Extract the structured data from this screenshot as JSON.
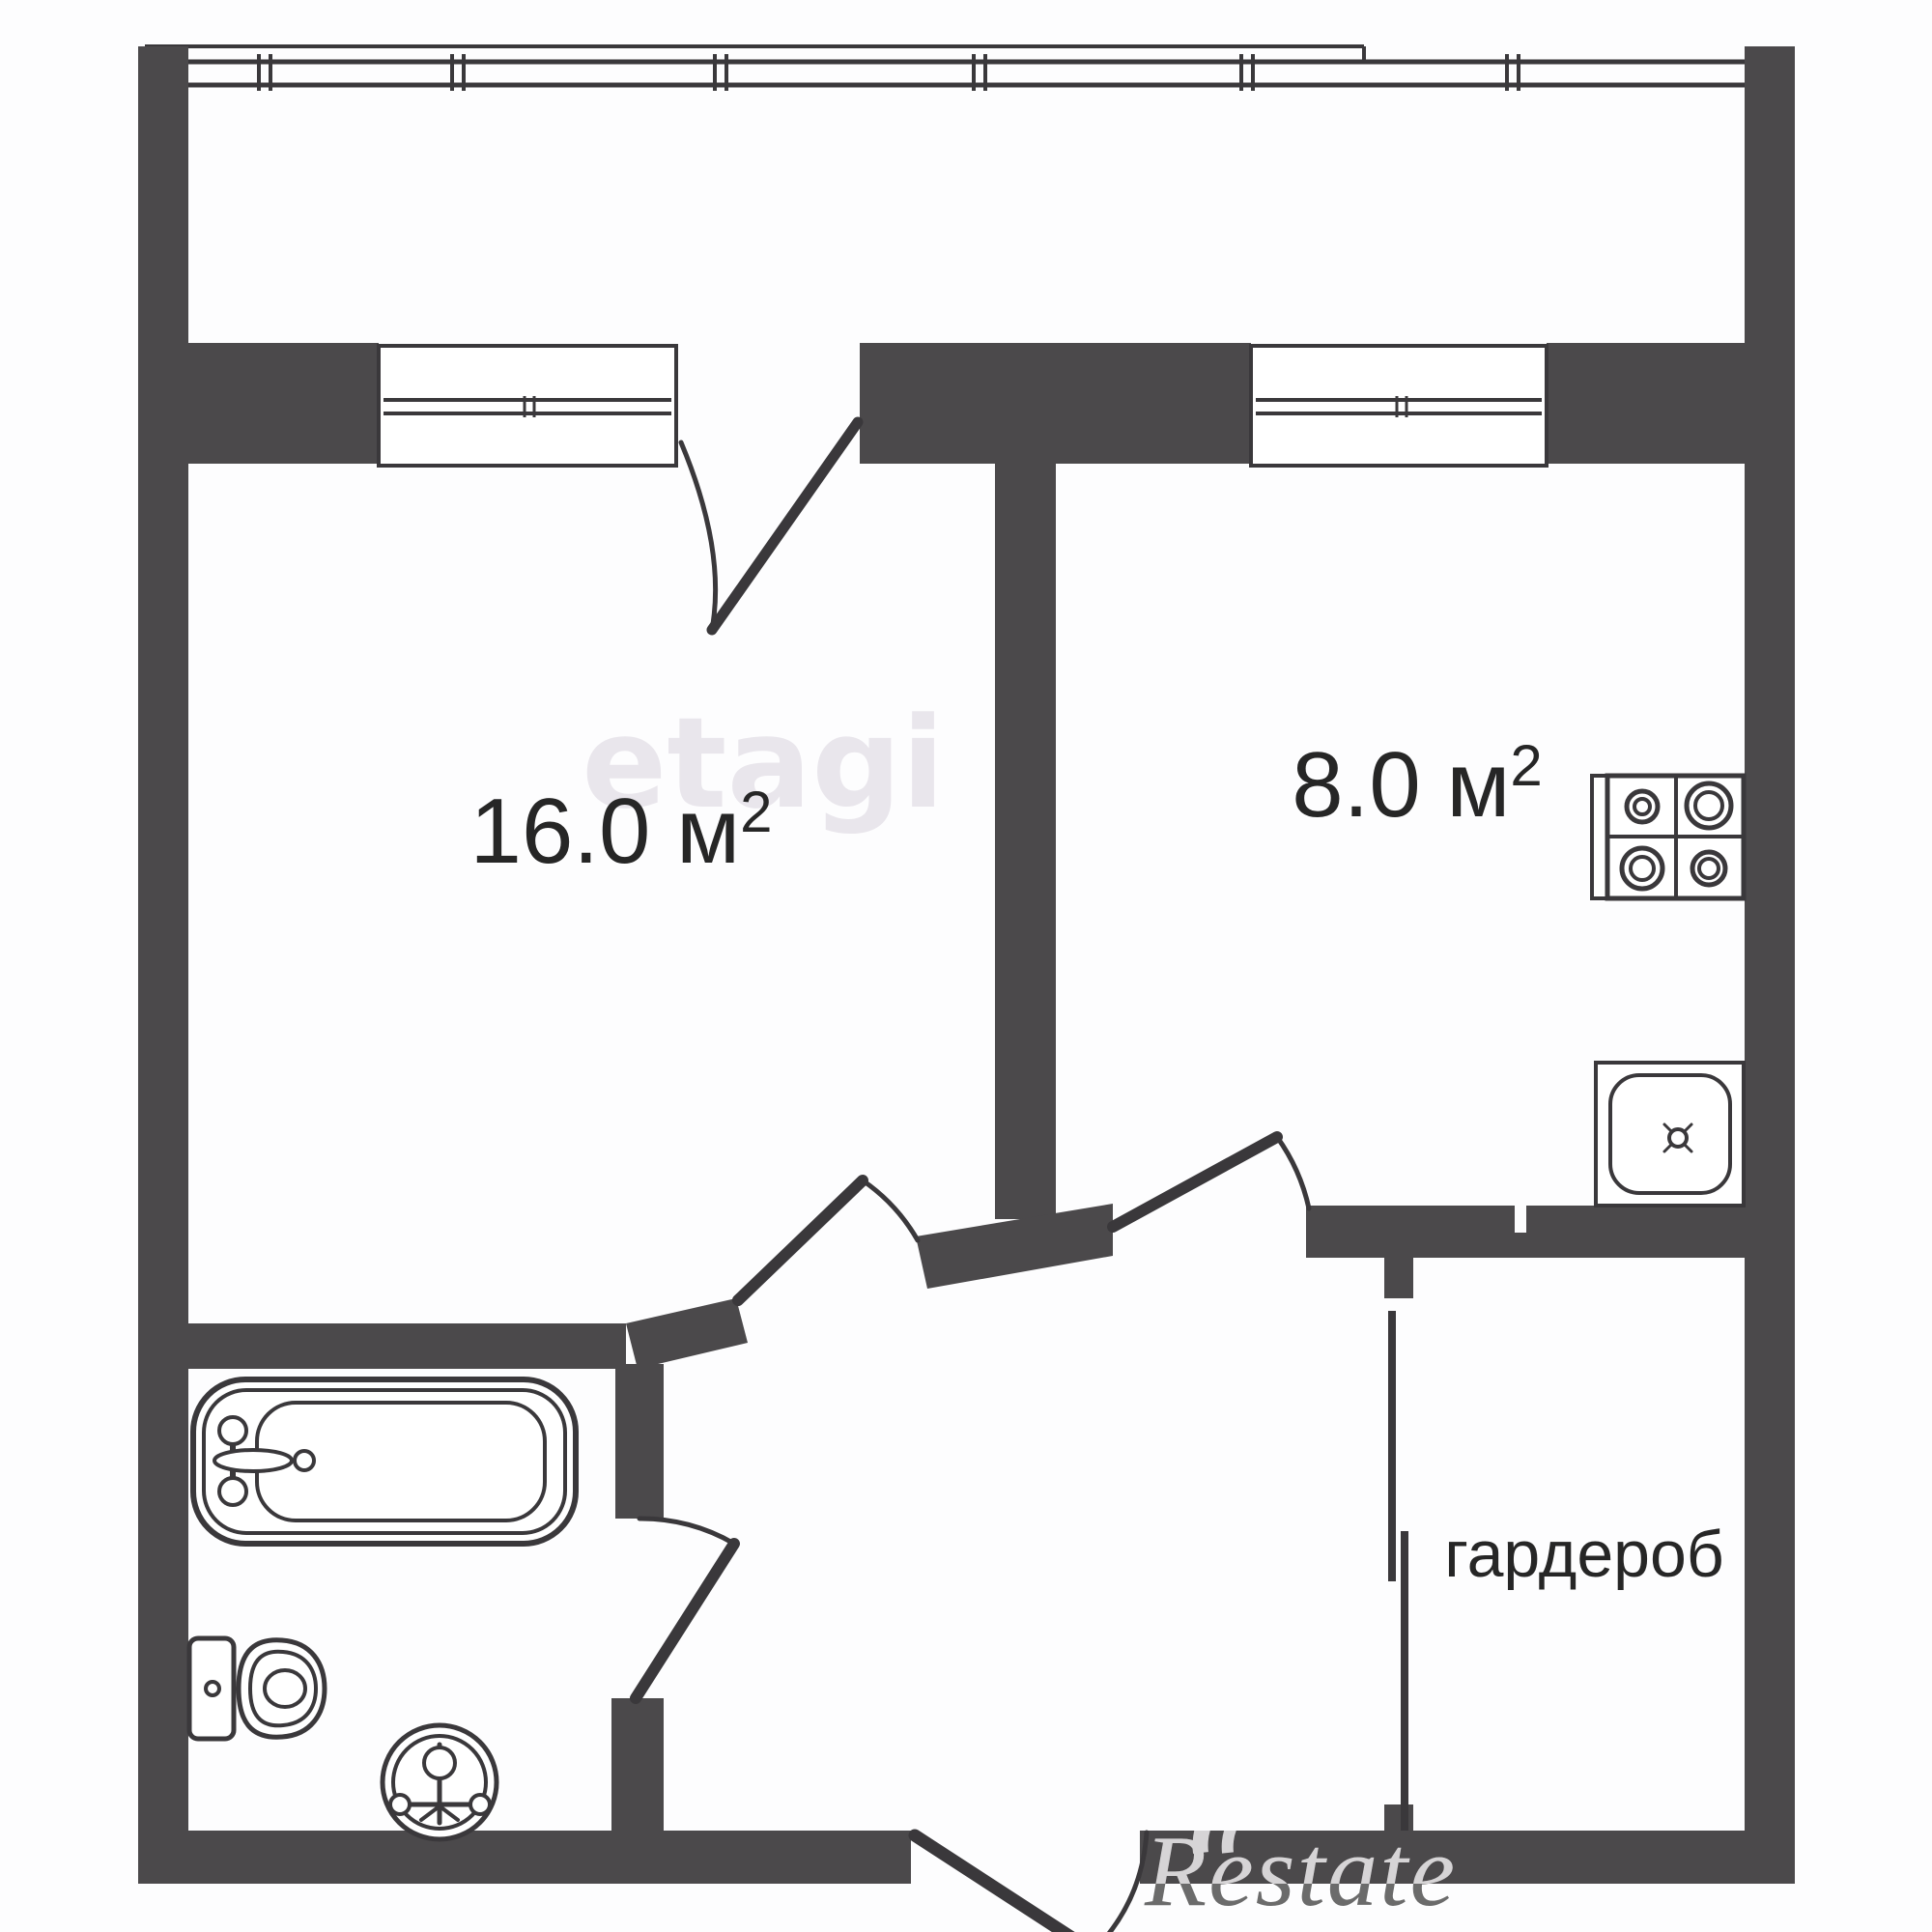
{
  "rooms": {
    "living": {
      "area": "16.0 м",
      "sup": "2"
    },
    "kitchen": {
      "area": "8.0 м",
      "sup": "2"
    },
    "wardrobe": {
      "label": "гардероб"
    }
  },
  "watermarks": {
    "center": "etagi",
    "corner": "Restate"
  },
  "fixtures": [
    "bathtub",
    "toilet",
    "floor-drain",
    "stove-4-burners",
    "kitchen-sink"
  ],
  "colors": {
    "wall": "#4b494b",
    "line": "#3a383b",
    "text": "#262626",
    "muted": "#e9e6ec",
    "bg": "#fdfdfe",
    "wm_dark": "#6b6b6b",
    "wm_light": "#d6d4d6"
  }
}
